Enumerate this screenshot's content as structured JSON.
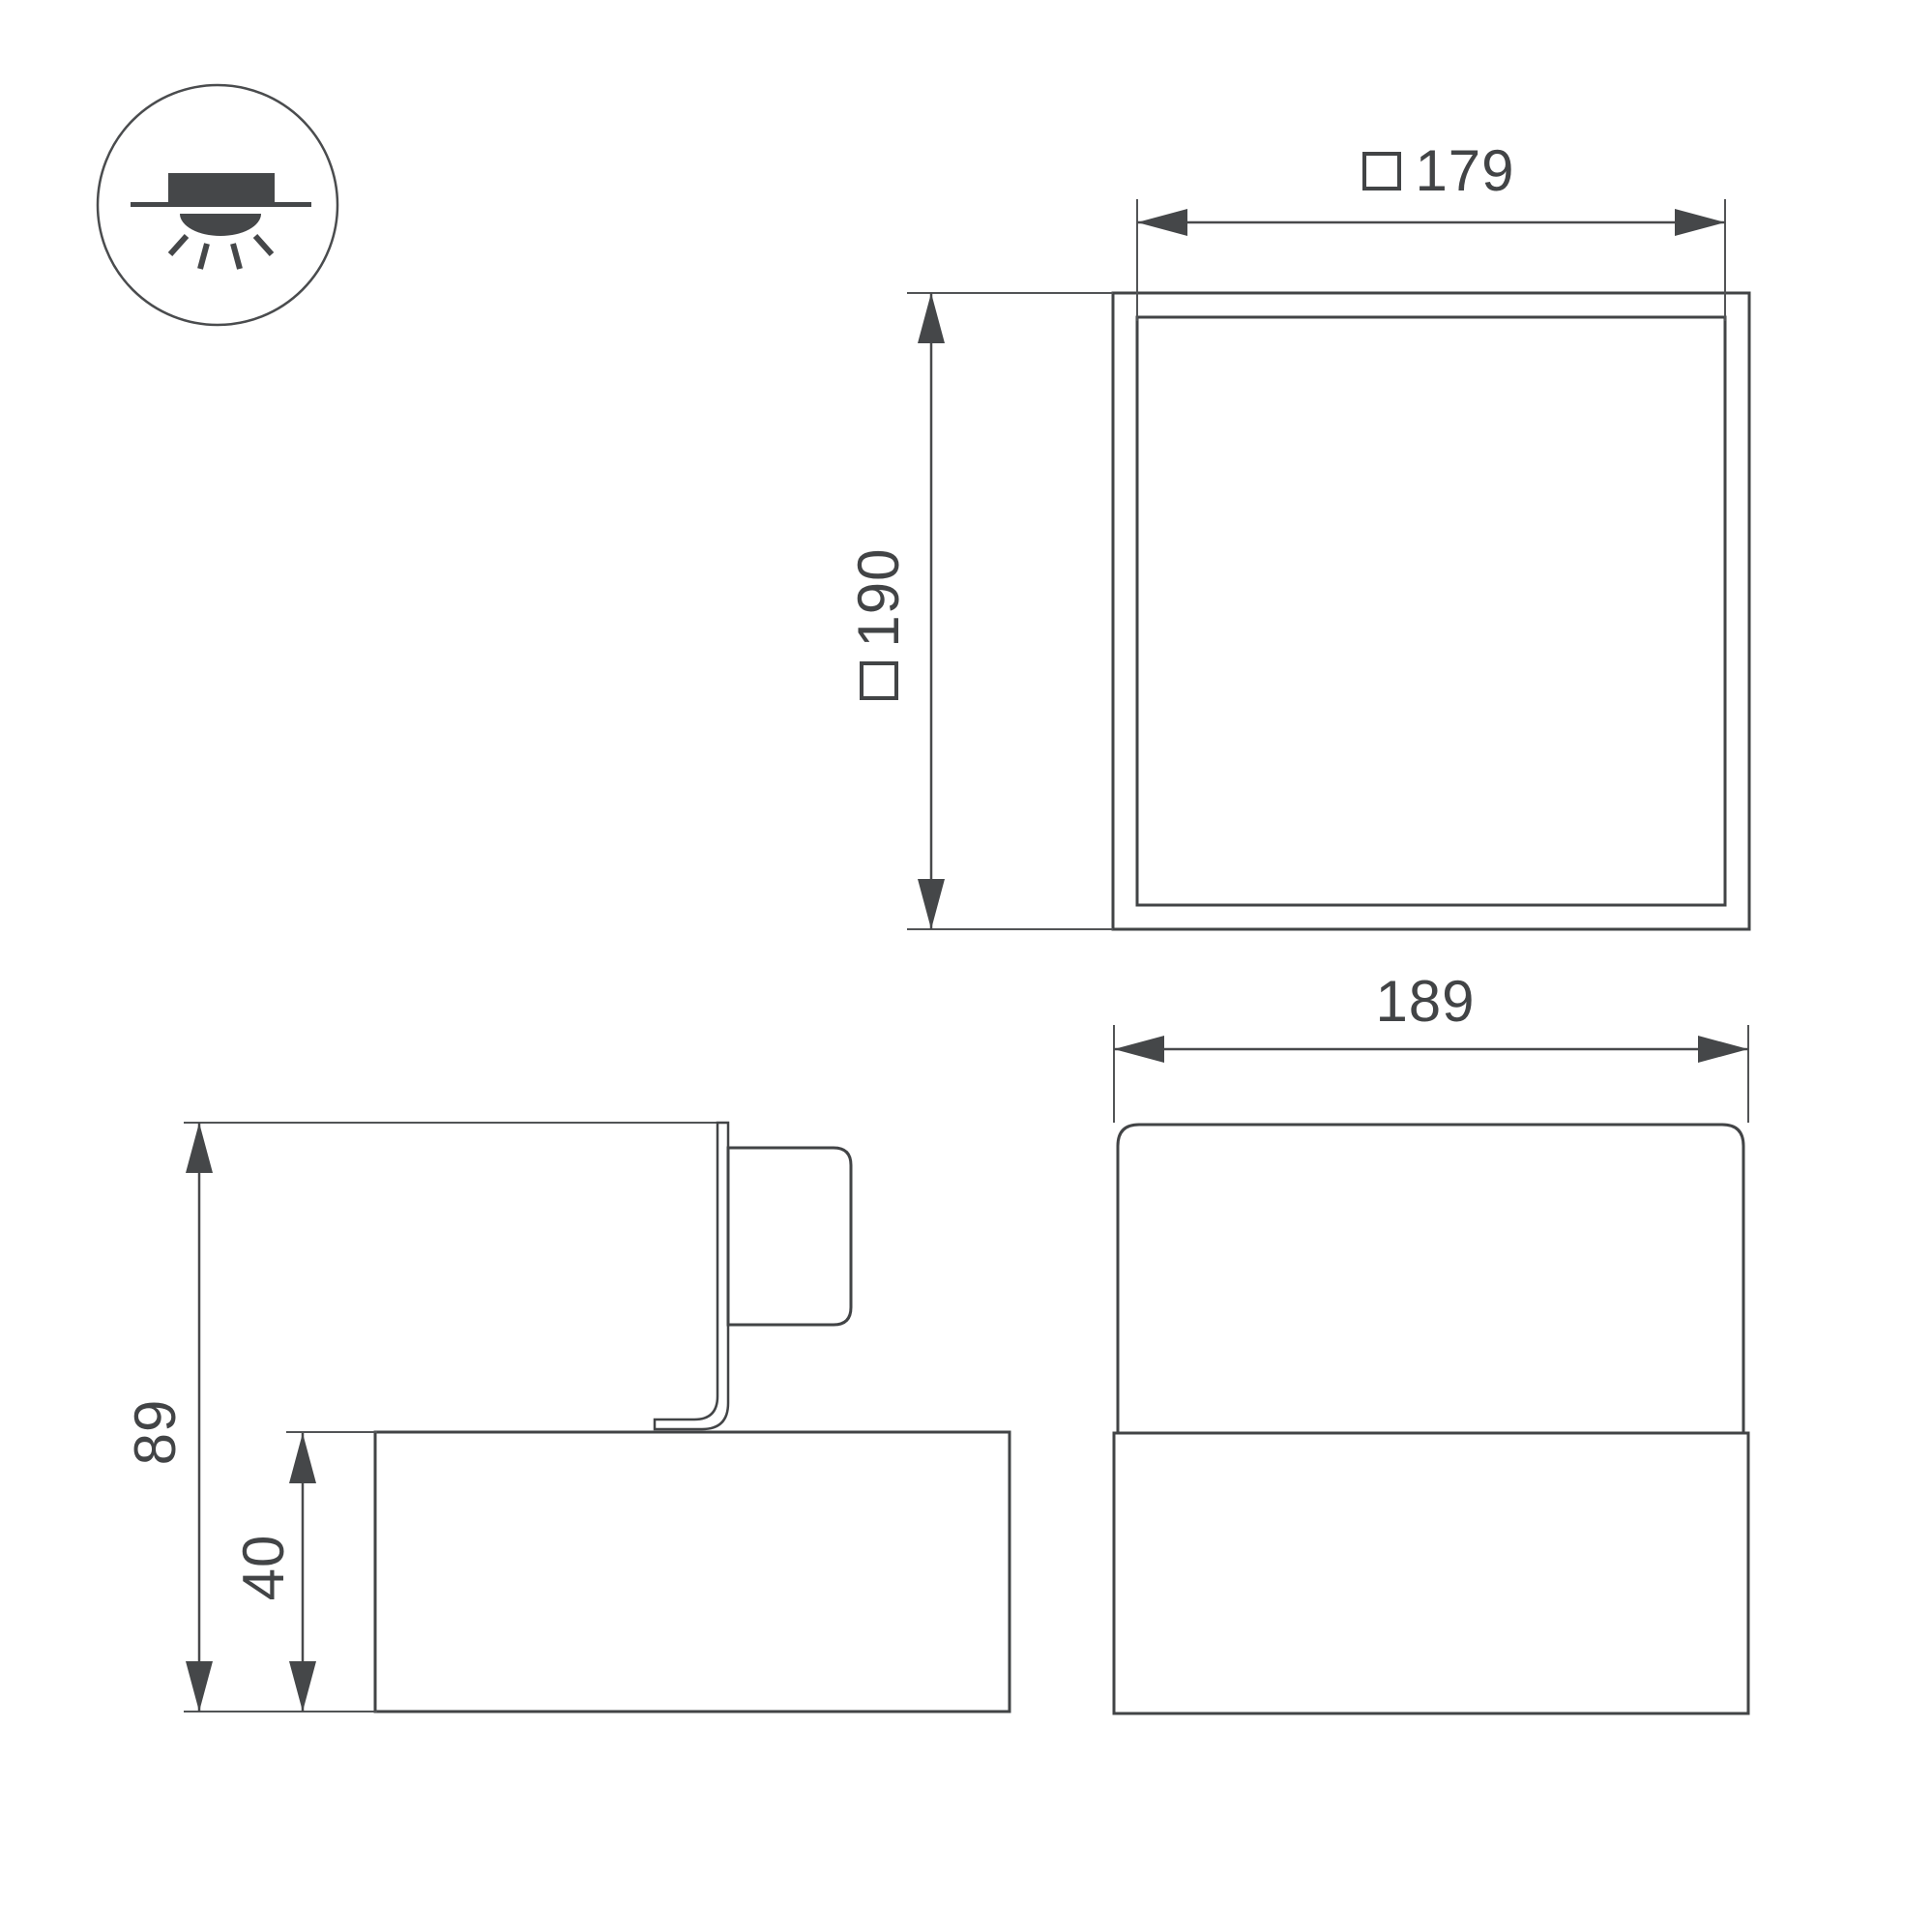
{
  "drawing": {
    "type": "luminaire-dimension-drawing",
    "background": "#ffffff",
    "units_shown": false
  },
  "icon": {
    "meaning": "surface-mounted-ceiling-light",
    "parts": [
      "ceiling-line",
      "fixture-body",
      "light-dome",
      "light-rays"
    ]
  },
  "dimensions": {
    "top_view_inner_width": {
      "symbol": "square",
      "value": "179"
    },
    "top_view_outer_size": {
      "symbol": "square",
      "value": "190"
    },
    "front_view_width": {
      "value": "189"
    },
    "side_view_total_height": {
      "value": "89"
    },
    "side_view_base_height": {
      "value": "40"
    }
  },
  "colors": {
    "ink": "#424446",
    "dim_line": "#48494b",
    "thin_line": "#525456",
    "background": "#ffffff"
  }
}
